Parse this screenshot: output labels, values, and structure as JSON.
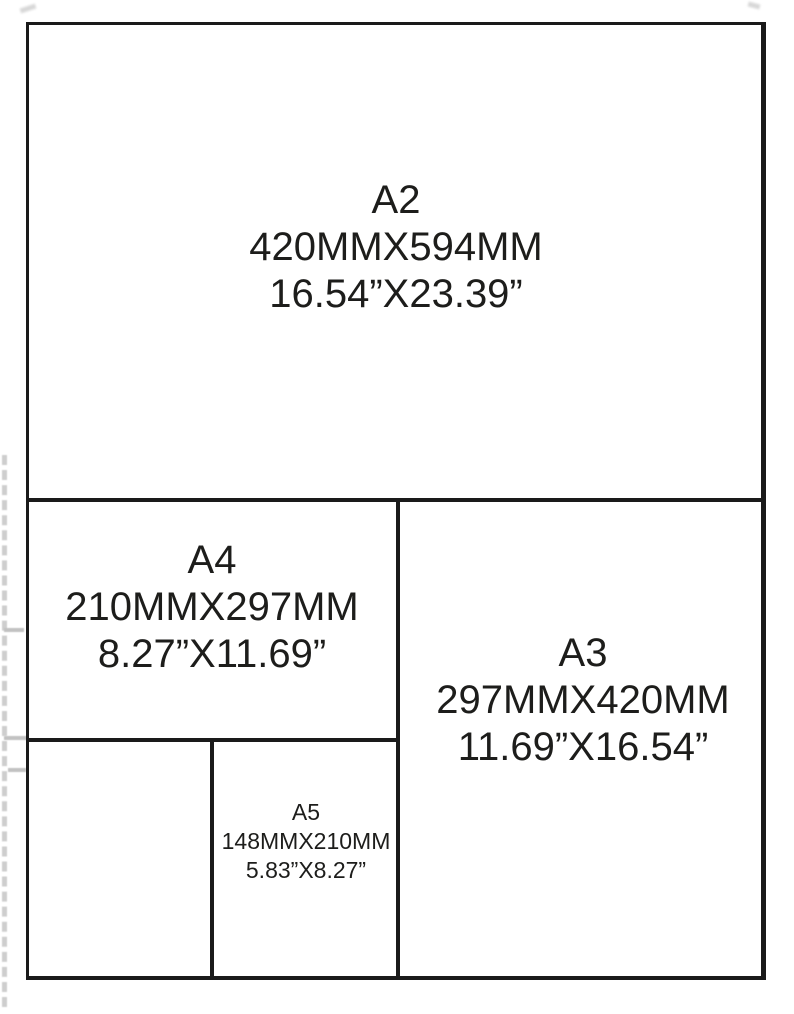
{
  "diagram_title": "paper-size-comparison",
  "colors": {
    "background": "#ffffff",
    "line": "#1a1a1a",
    "text": "#1d1d1b",
    "artifact_gray": "#c6c6c6"
  },
  "papers": {
    "a2": {
      "name": "A2",
      "mm": "420MMX594MM",
      "inches": "16.54”X23.39”"
    },
    "a4": {
      "name": "A4",
      "mm": "210MMX297MM",
      "inches": "8.27”X11.69”"
    },
    "a3": {
      "name": "A3",
      "mm": "297MMX420MM",
      "inches": "11.69”X16.54”"
    },
    "a5": {
      "name": "A5",
      "mm": "148MMX210MM",
      "inches": "5.83”X8.27”"
    }
  }
}
